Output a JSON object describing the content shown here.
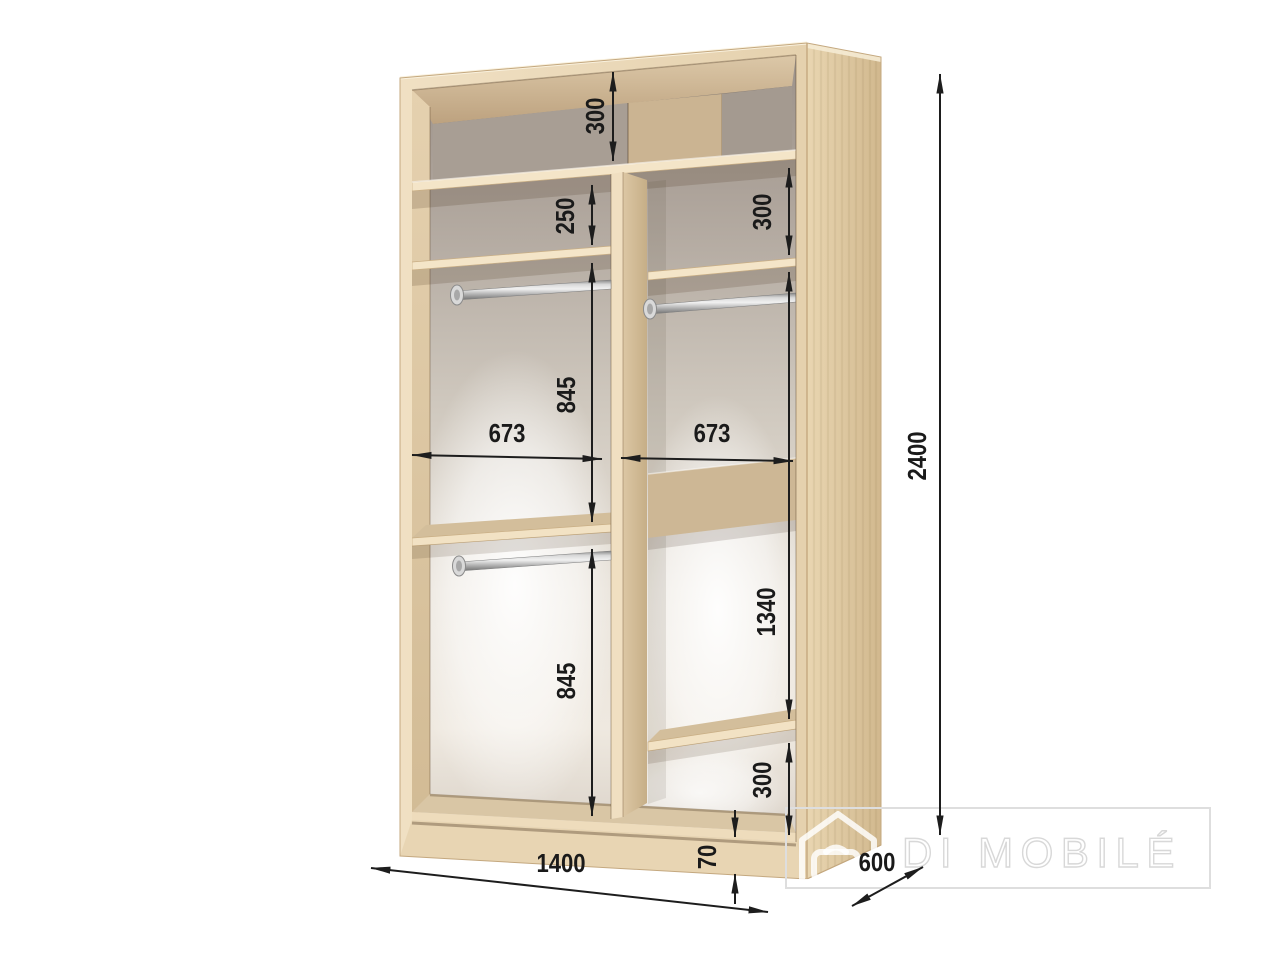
{
  "diagram": {
    "subject": "wardrobe-interior-dimension-drawing",
    "dims": {
      "top_section": "300",
      "left_upper_gap": "250",
      "right_upper_gap": "300",
      "left_hang_upper": "845",
      "left_inner_width": "673",
      "right_inner_width": "673",
      "left_hang_lower": "845",
      "right_tall_section": "1340",
      "right_bottom_section": "300",
      "plinth_height": "70",
      "overall_width": "1400",
      "overall_depth": "600",
      "overall_height": "2400"
    },
    "watermark": {
      "brand": "DI MOBILÉ"
    },
    "colors": {
      "dimension_ink": "#1d1d1d",
      "wood_front": "#ecd9ba",
      "wood_side": "#dcc49c",
      "back_panel_grey": "#a89e94",
      "watermark_grey": "#dedede"
    }
  }
}
